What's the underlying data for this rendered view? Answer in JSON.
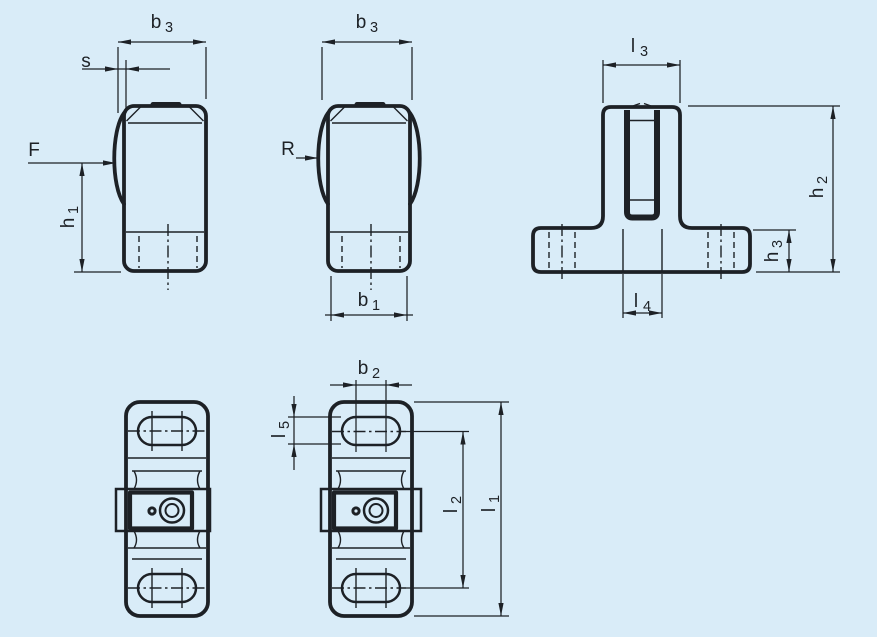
{
  "drawing": {
    "type": "technical-dimension-drawing",
    "colors": {
      "background": "#d9ecf8",
      "lines": "#1d2126"
    },
    "views": {
      "front_a": "front view variant A (single side bulge)",
      "front_b": "front view variant B (both side bulges)",
      "side": "side view (T-shaped base)",
      "plan_a": "plan view variant A",
      "plan_b": "plan view variant B (dimensioned)"
    },
    "labels": {
      "b3_a": {
        "base": "b",
        "sub": "3"
      },
      "s": {
        "base": "s",
        "sub": ""
      },
      "f": {
        "base": "F",
        "sub": ""
      },
      "h1": {
        "base": "h",
        "sub": "1"
      },
      "b3_b": {
        "base": "b",
        "sub": "3"
      },
      "r": {
        "base": "R",
        "sub": ""
      },
      "b1": {
        "base": "b",
        "sub": "1"
      },
      "l3": {
        "base": "l",
        "sub": "3"
      },
      "h2": {
        "base": "h",
        "sub": "2"
      },
      "h3": {
        "base": "h",
        "sub": "3"
      },
      "l4": {
        "base": "l",
        "sub": "4"
      },
      "b2": {
        "base": "b",
        "sub": "2"
      },
      "l5": {
        "base": "l",
        "sub": "5"
      },
      "l2": {
        "base": "l",
        "sub": "2"
      },
      "l1": {
        "base": "l",
        "sub": "1"
      }
    }
  }
}
